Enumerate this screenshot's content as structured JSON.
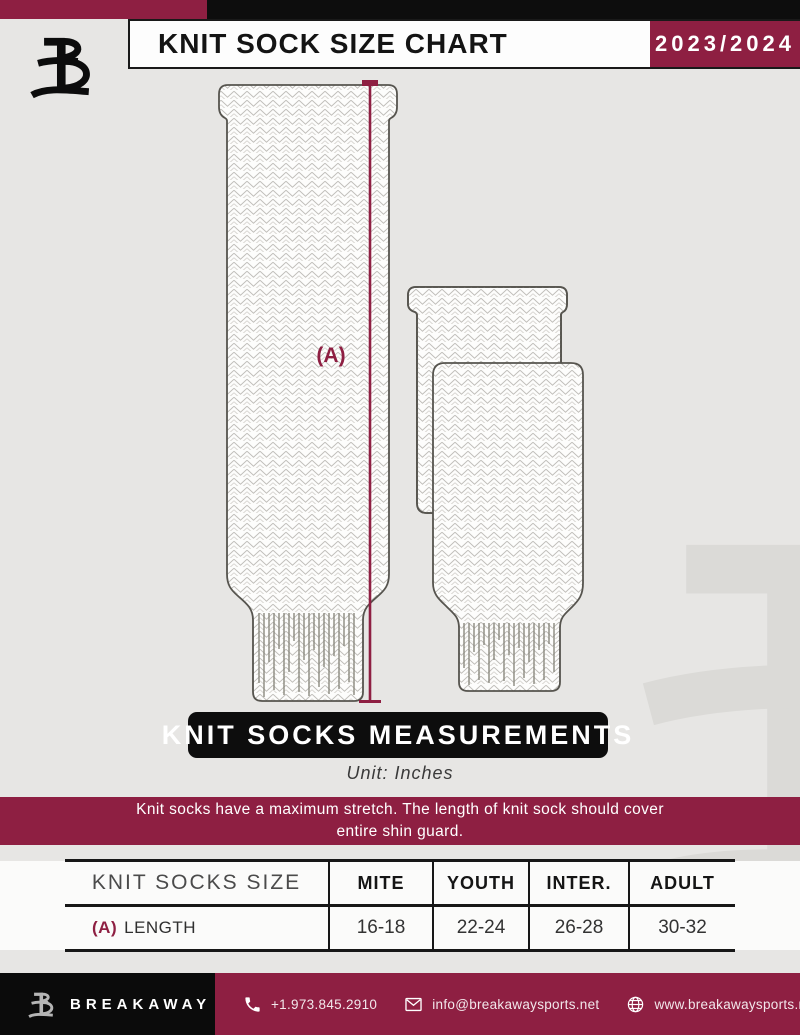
{
  "header": {
    "title": "KNIT SOCK SIZE CHART",
    "season": "2023/2024"
  },
  "diagram": {
    "measurement_label": "(A)"
  },
  "measurements": {
    "banner": "KNIT SOCKS MEASUREMENTS",
    "unit": "Unit: Inches"
  },
  "note": {
    "line1": "Knit socks have a maximum stretch. The length of knit sock should cover",
    "line2": "entire shin guard."
  },
  "table": {
    "header": [
      "KNIT SOCKS SIZE",
      "MITE",
      "YOUTH",
      "INTER.",
      "ADULT"
    ],
    "rows": [
      {
        "prefix": "(A)",
        "label": "LENGTH",
        "values": [
          "16-18",
          "22-24",
          "26-28",
          "30-32"
        ]
      }
    ]
  },
  "chart_data": {
    "type": "table",
    "title": "KNIT SOCK SIZE CHART",
    "columns": [
      "KNIT SOCKS SIZE",
      "MITE",
      "YOUTH",
      "INTER.",
      "ADULT"
    ],
    "rows": [
      [
        "(A) LENGTH",
        "16-18",
        "22-24",
        "26-28",
        "30-32"
      ]
    ],
    "unit": "Inches"
  },
  "footer": {
    "brand": "BREAKAWAY",
    "phone": "+1.973.845.2910",
    "email": "info@breakawaysports.net",
    "website": "www.breakawaysports.net"
  },
  "colors": {
    "maroon": "#8e1f42",
    "black": "#0d0d0d",
    "background": "#e7e6e4"
  }
}
